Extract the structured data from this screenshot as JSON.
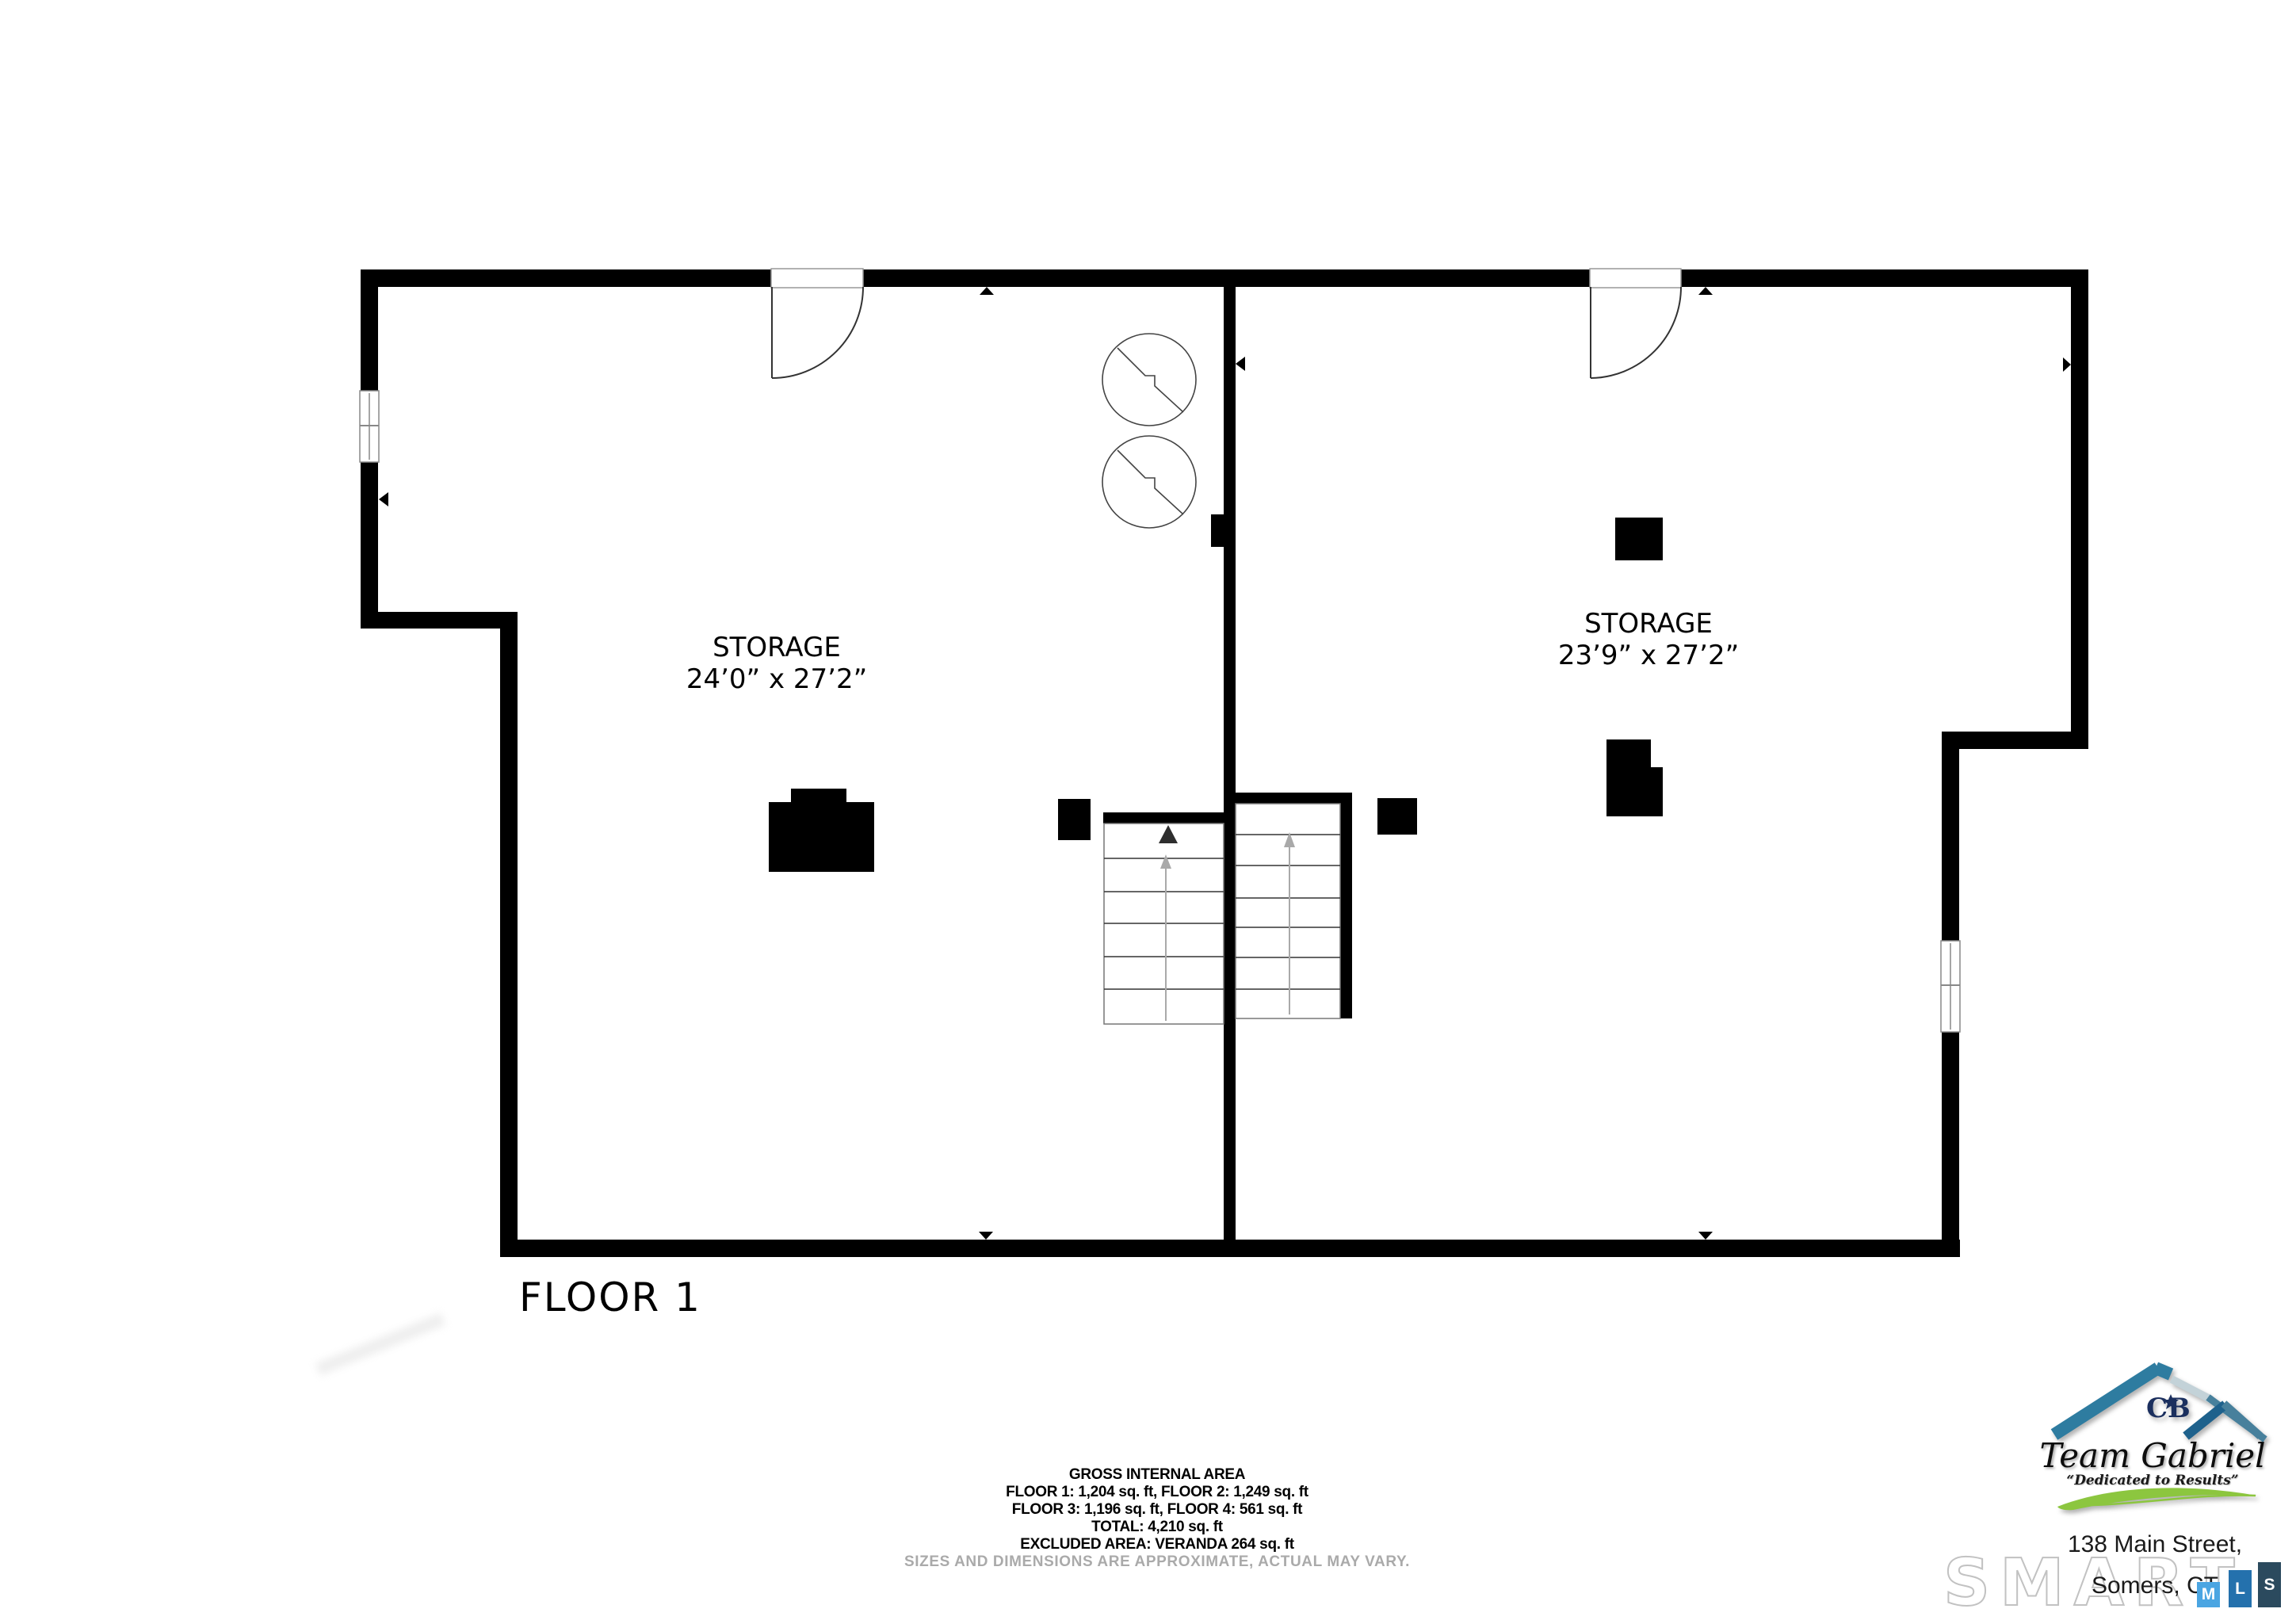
{
  "floor_label": "FLOOR 1",
  "rooms": [
    {
      "name": "STORAGE",
      "dims": "24’0” x 27’2”"
    },
    {
      "name": "STORAGE",
      "dims": "23’9” x 27’2”"
    }
  ],
  "area_summary": {
    "title": "GROSS INTERNAL AREA",
    "floors_1_2": "FLOOR 1: 1,204 sq. ft, FLOOR 2: 1,249 sq. ft",
    "floors_3_4": "FLOOR 3: 1,196 sq. ft, FLOOR 4: 561 sq. ft",
    "total": "TOTAL: 4,210 sq. ft",
    "excluded": "EXCLUDED AREA: VERANDA 264 sq. ft",
    "disclaimer": "SIZES AND DIMENSIONS ARE APPROXIMATE, ACTUAL MAY VARY."
  },
  "branding": {
    "monogram": "CB",
    "team_name": "Team Gabriel",
    "tagline": "“Dedicated to Results”",
    "address_line1": "138 Main Street,",
    "address_line2": "Somers, CT",
    "watermark": "SMART",
    "mls_letters": [
      "M",
      "L",
      "S"
    ],
    "colors": {
      "wall_black": "#000000",
      "roof_teal": "#2e7ca0",
      "roof_steel": "#47809c",
      "roof_pale": "#c3d2d8",
      "roof_dark": "#1e618c",
      "swoosh_green": "#8cc63f",
      "monogram_navy": "#1b2f5e",
      "mls_m_blue": "#4aa5e2",
      "mls_l_blue": "#2471ad",
      "mls_s_slate": "#2b4a5e",
      "disclaimer_gray": "#aaaaaa"
    }
  }
}
